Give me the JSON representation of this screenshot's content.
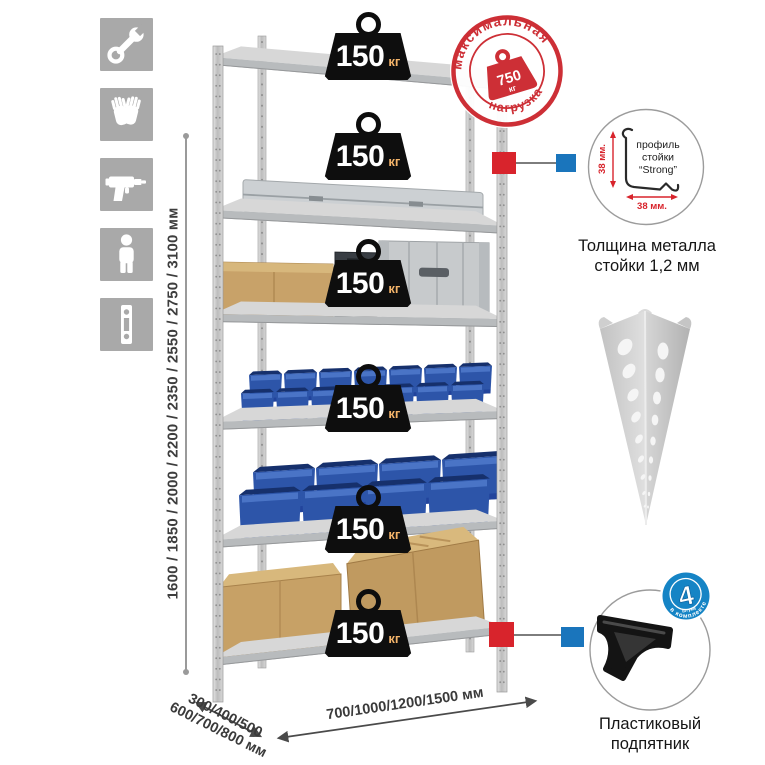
{
  "dimensions": {
    "height": "1600 / 1850 / 2000 / 2200 / 2350 / 2550 / 2750 / 3100 мм",
    "depth_line1": "300/400/500",
    "depth_line2": "600/700/800 мм",
    "width": "700/1000/1200/1500 мм"
  },
  "rack": {
    "loads": [
      {
        "value": "150",
        "unit": "кг"
      },
      {
        "value": "150",
        "unit": "кг"
      },
      {
        "value": "150",
        "unit": "кг"
      },
      {
        "value": "150",
        "unit": "кг"
      },
      {
        "value": "150",
        "unit": "кг"
      },
      {
        "value": "150",
        "unit": "кг"
      }
    ]
  },
  "stamp": {
    "arc_top": "максимальная",
    "arc_bottom": "нагрузка",
    "value": "750",
    "unit": "кг"
  },
  "profile_detail": {
    "label_line1": "профиль",
    "label_line2": "стойки",
    "label_line3": "“Strong”",
    "dim_vertical": "38 мм.",
    "dim_horizontal": "38 мм.",
    "caption_line1": "Толщина металла",
    "caption_line2": "стойки 1,2 мм"
  },
  "foot_detail": {
    "badge_value": "4",
    "badge_small": "штуки",
    "badge_arc": "в комплекте",
    "caption_line1": "Пластиковый",
    "caption_line2": "подпятник"
  },
  "icons": [
    "wrench",
    "gloves",
    "drill",
    "person",
    "upright-strip"
  ],
  "colors": {
    "accent_red": "#d8242c",
    "accent_blue": "#1a75bc",
    "stamp_red": "#cd2f36",
    "badge_blue": "#1584c5",
    "bin_blue": "#2d55a9",
    "metal_gray": "#c6c9cb",
    "icon_gray": "#a9a9a9",
    "load_unit_text": "#f2b369"
  }
}
